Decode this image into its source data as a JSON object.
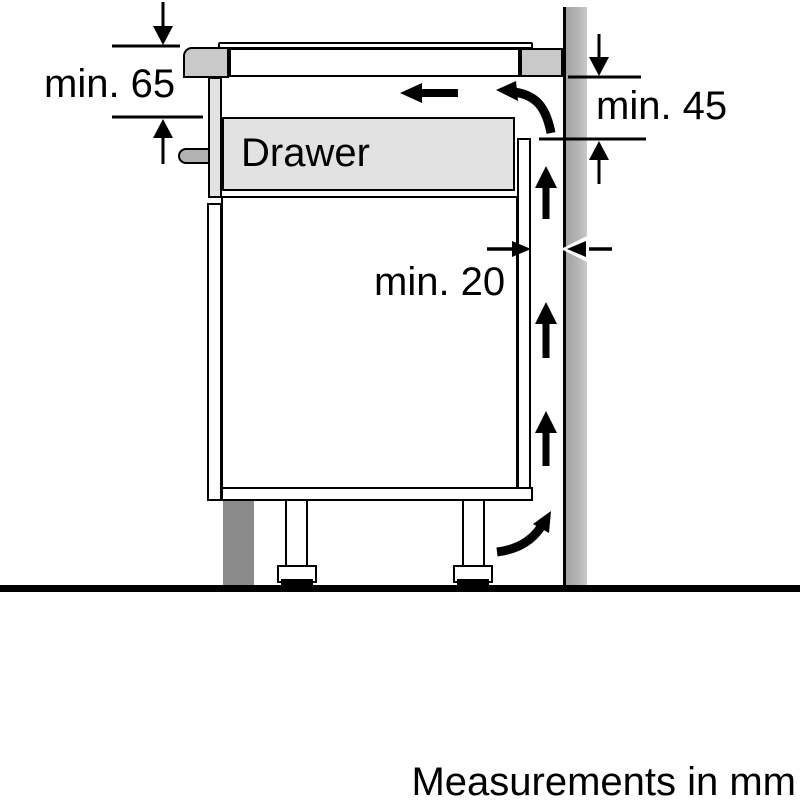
{
  "diagram": {
    "labels": {
      "min65": "min. 65",
      "min45": "min. 45",
      "min20": "min. 20",
      "drawer": "Drawer",
      "footer": "Measurements in mm"
    },
    "colors": {
      "outline": "#000000",
      "background": "#ffffff",
      "worktop_gray": "#c9c9c9",
      "drawer_gray": "#e2e2e2",
      "panel_gray": "#e2e2e2",
      "tab_gray": "#b3b3b3",
      "plinth_dark_gray": "#8a8a8a",
      "wall_gray": "#b4b4b4"
    }
  }
}
